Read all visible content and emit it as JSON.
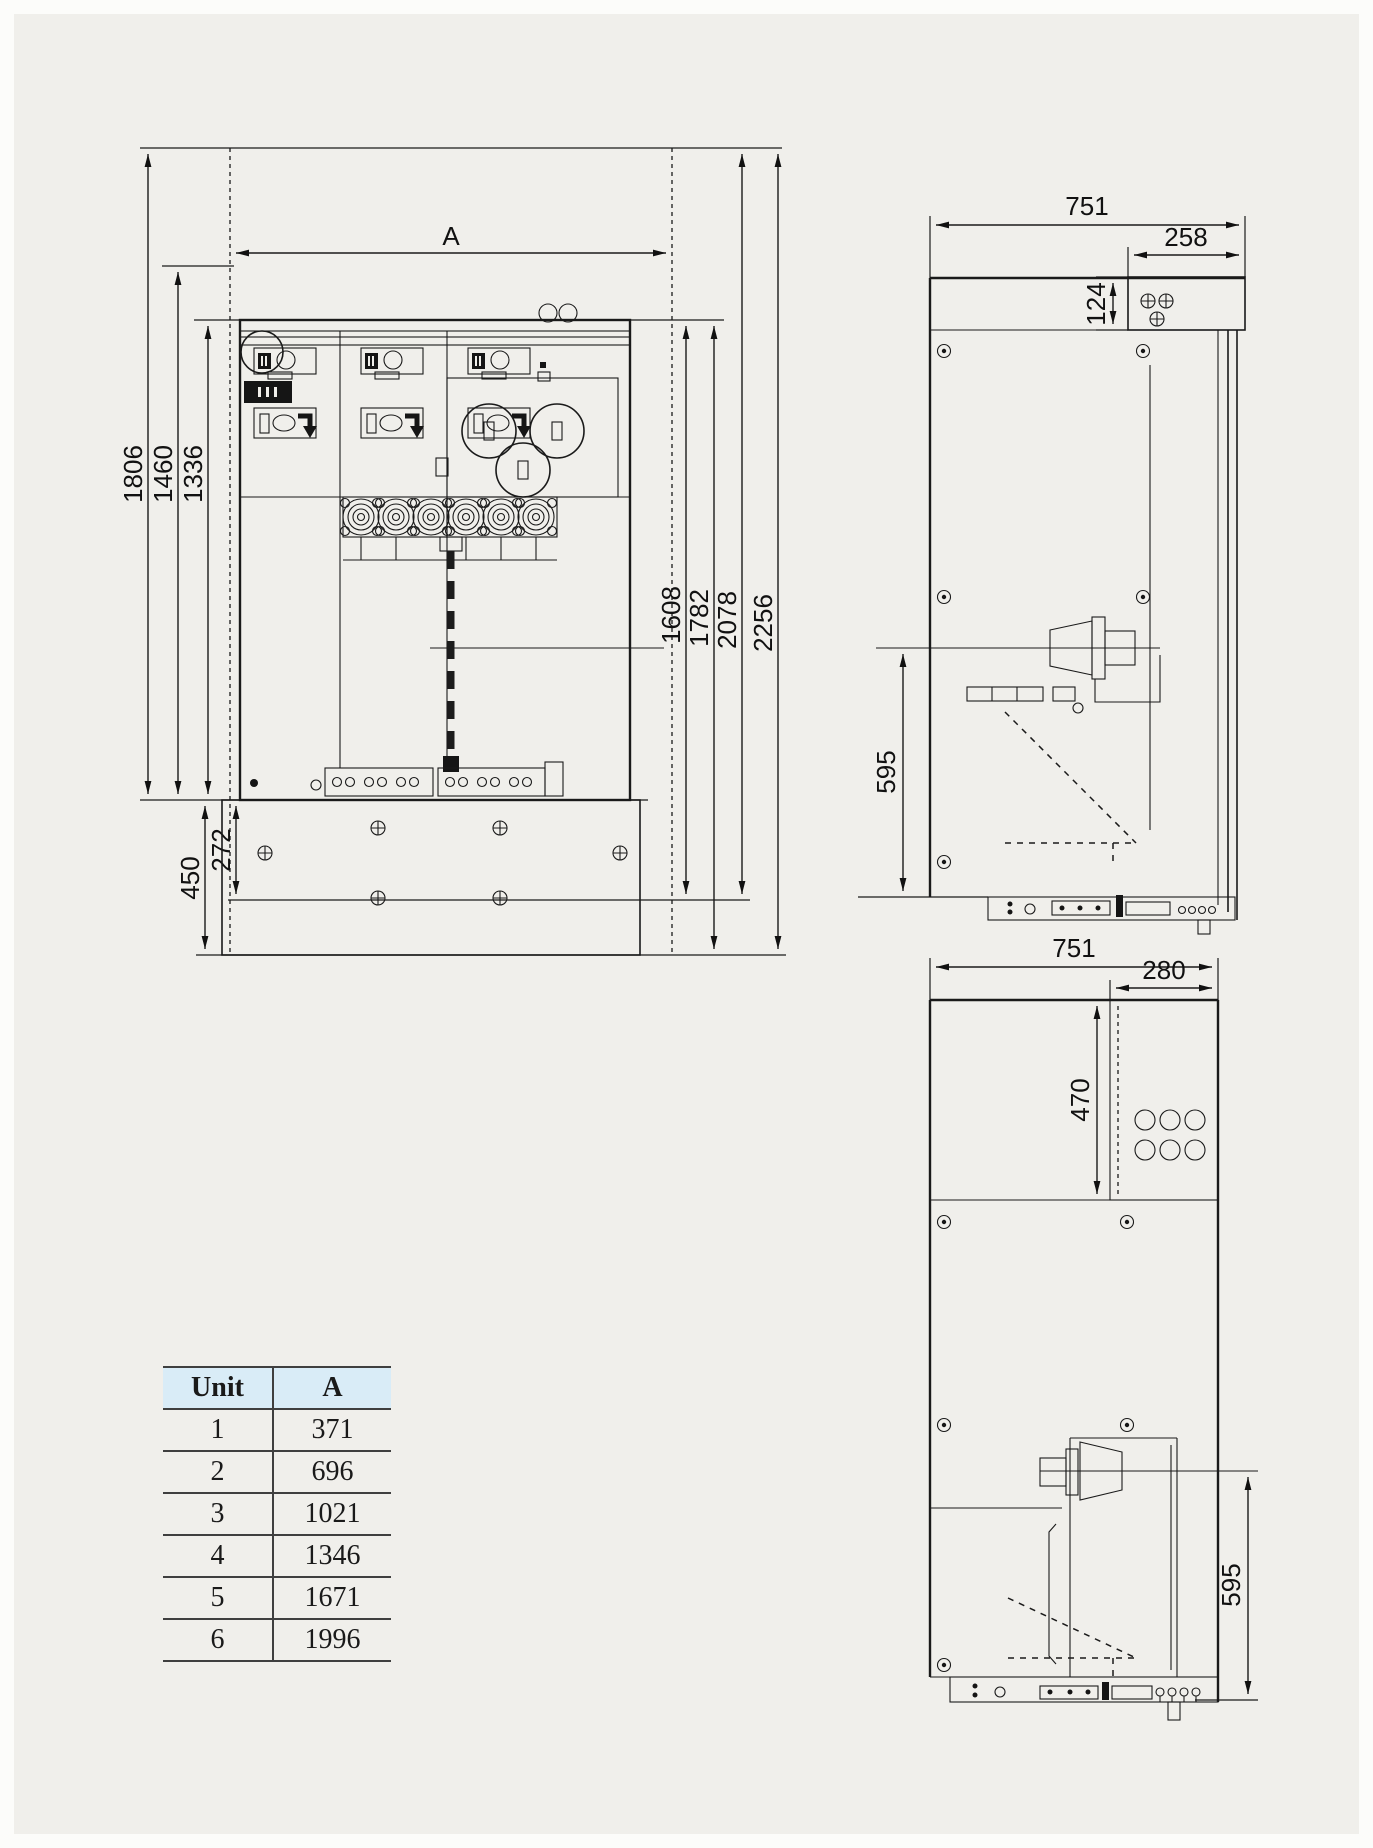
{
  "drawing": {
    "title": "switchgear-dimensional-drawing",
    "front_view": {
      "dim_width_label": "A",
      "dim_total_height": "1806",
      "dim_mid_height": "1460",
      "dim_body_height": "1336",
      "dim_right_1": "1608",
      "dim_right_2": "1782",
      "dim_right_3": "2078",
      "dim_right_4": "2256",
      "dim_base_height": "450",
      "dim_base_inner": "272"
    },
    "side_view_top": {
      "dim_depth": "751",
      "dim_top_box_depth": "258",
      "dim_top_box_height": "124",
      "dim_bushing_height": "595"
    },
    "side_view_bottom": {
      "dim_depth": "751",
      "dim_top_box_depth": "280",
      "dim_top_box_height": "470",
      "dim_bushing_height": "595"
    }
  },
  "size_table": {
    "headers": [
      "Unit",
      "A"
    ],
    "rows": [
      [
        "1",
        "371"
      ],
      [
        "2",
        "696"
      ],
      [
        "3",
        "1021"
      ],
      [
        "4",
        "1346"
      ],
      [
        "5",
        "1671"
      ],
      [
        "6",
        "1996"
      ]
    ]
  },
  "colors": {
    "line": "#1a1a1a",
    "background": "#f0efeb",
    "table_header_bg": "#d9ecf7"
  }
}
